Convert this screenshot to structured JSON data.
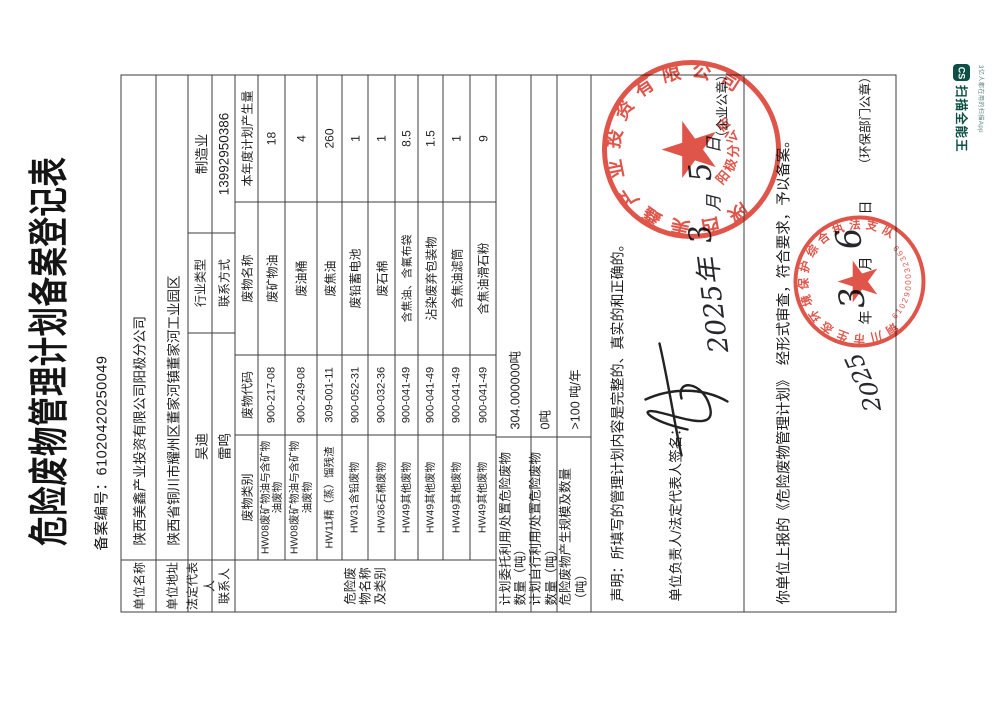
{
  "watermark": {
    "logo": "CS",
    "title": "扫描全能王",
    "tagline": "3亿人都在用的扫描App"
  },
  "doc": {
    "title": "危险废物管理计划备案登记表",
    "record_no_label": "备案编号：",
    "record_no": "61020420250049",
    "fields": {
      "unit_name_label": "单位名称",
      "unit_name": "陕西美鑫产业投资有限公司阳极分公司",
      "unit_addr_label": "单位地址",
      "unit_addr": "陕西省铜川市耀州区董家河镇董家河工业园区",
      "legal_rep_label": "法定代表人",
      "legal_rep": "吴迪",
      "industry_label": "行业类型",
      "industry": "制造业",
      "contact_label": "联系人",
      "contact": "雷鸣",
      "contact_way_label": "联系方式",
      "contact_way": "13992950386"
    },
    "waste_table": {
      "side_label": "危险废物名称及类别",
      "headers": [
        "废物类别",
        "废物代码",
        "废物名称",
        "本年度计划产生量"
      ],
      "rows": [
        {
          "category": "HW08废矿物油与含矿物油废物",
          "code": "900-217-08",
          "name": "废矿物油",
          "amount": "18"
        },
        {
          "category": "HW08废矿物油与含矿物油废物",
          "code": "900-249-08",
          "name": "废油桶",
          "amount": "4"
        },
        {
          "category": "HW11精（蒸）馏残渣",
          "code": "309-001-11",
          "name": "废焦油",
          "amount": "260"
        },
        {
          "category": "HW31含铅废物",
          "code": "900-052-31",
          "name": "废铅蓄电池",
          "amount": "1"
        },
        {
          "category": "HW36石棉废物",
          "code": "900-032-36",
          "name": "废石棉",
          "amount": "1"
        },
        {
          "category": "HW49其他废物",
          "code": "900-041-49",
          "name": "含焦油、含氟布袋",
          "amount": "8.5"
        },
        {
          "category": "HW49其他废物",
          "code": "900-041-49",
          "name": "沾染废弃包装物",
          "amount": "1.5"
        },
        {
          "category": "HW49其他废物",
          "code": "900-041-49",
          "name": "含焦油滤筒",
          "amount": "1"
        },
        {
          "category": "HW49其他废物",
          "code": "900-041-49",
          "name": "含焦油滑石粉",
          "amount": "9"
        }
      ]
    },
    "summary_rows": [
      {
        "label": "计划委托利用/处置危险废物数量（吨）",
        "value": "304.000000吨"
      },
      {
        "label": "计划自行利用/处置危险废物数量（吨）",
        "value": "0吨"
      },
      {
        "label": "危险废物产生规模及数量（吨）",
        "value": ">100 吨/年"
      }
    ],
    "declaration": {
      "statement": "声明：所填写的管理计划内容是完整的、真实的和正确的。",
      "sign_label": "单位负责人/法定代表人签名：",
      "date_parts": [
        "2025年",
        "3",
        "月",
        "5",
        "日"
      ],
      "seal_note": "（企业公章）",
      "stamp_ring_text": "陕西美鑫产业投资有限公司",
      "stamp_sub_text": "阳极分公司"
    },
    "approval": {
      "text": "你单位上报的《危险废物管理计划》　经形式审查，符合要求，予以备案。",
      "hand_year": "20",
      "hand_year2": "25",
      "year_char": "年",
      "hand_month": "3",
      "month_char": "月",
      "hand_day": "6",
      "day_char": "日",
      "seal_note": "（环保部门公章）",
      "stamp_ring_text": "铜川市生态环境保护综合执法支队",
      "stamp_code": "6102900032369"
    }
  }
}
